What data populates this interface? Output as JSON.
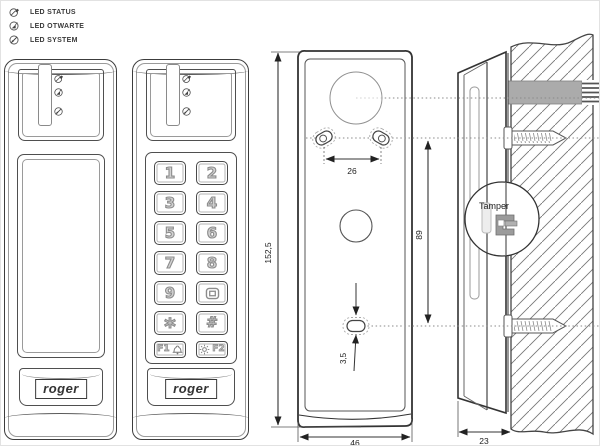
{
  "legend": {
    "items": [
      {
        "icon": "led-status-icon",
        "label": "LED STATUS"
      },
      {
        "icon": "led-otwarte-icon",
        "label": "LED OTWARTE"
      },
      {
        "icon": "led-system-icon",
        "label": "LED SYSTEM"
      }
    ]
  },
  "brand": {
    "logo": "roger"
  },
  "keypad": {
    "keys": [
      {
        "label": "1"
      },
      {
        "label": "2"
      },
      {
        "label": "3"
      },
      {
        "label": "4"
      },
      {
        "label": "5"
      },
      {
        "label": "6"
      },
      {
        "label": "7"
      },
      {
        "label": "8"
      },
      {
        "label": "9"
      },
      {
        "label": "",
        "icon": "square-icon"
      },
      {
        "label": "*"
      },
      {
        "label": "#"
      },
      {
        "label": "F1",
        "icon": "bell-icon"
      },
      {
        "label": "F2",
        "icon": "light-icon"
      }
    ]
  },
  "dimensions": {
    "height": "152,5",
    "hole_spacing": "26",
    "hole_offset": "89",
    "slot_height": "3,5",
    "width": "46",
    "depth": "23"
  },
  "side_view": {
    "tamper_label": "Tamper"
  },
  "colors": {
    "line": "#333333",
    "cable": "#ababab",
    "light_line": "#9a9a9a"
  }
}
